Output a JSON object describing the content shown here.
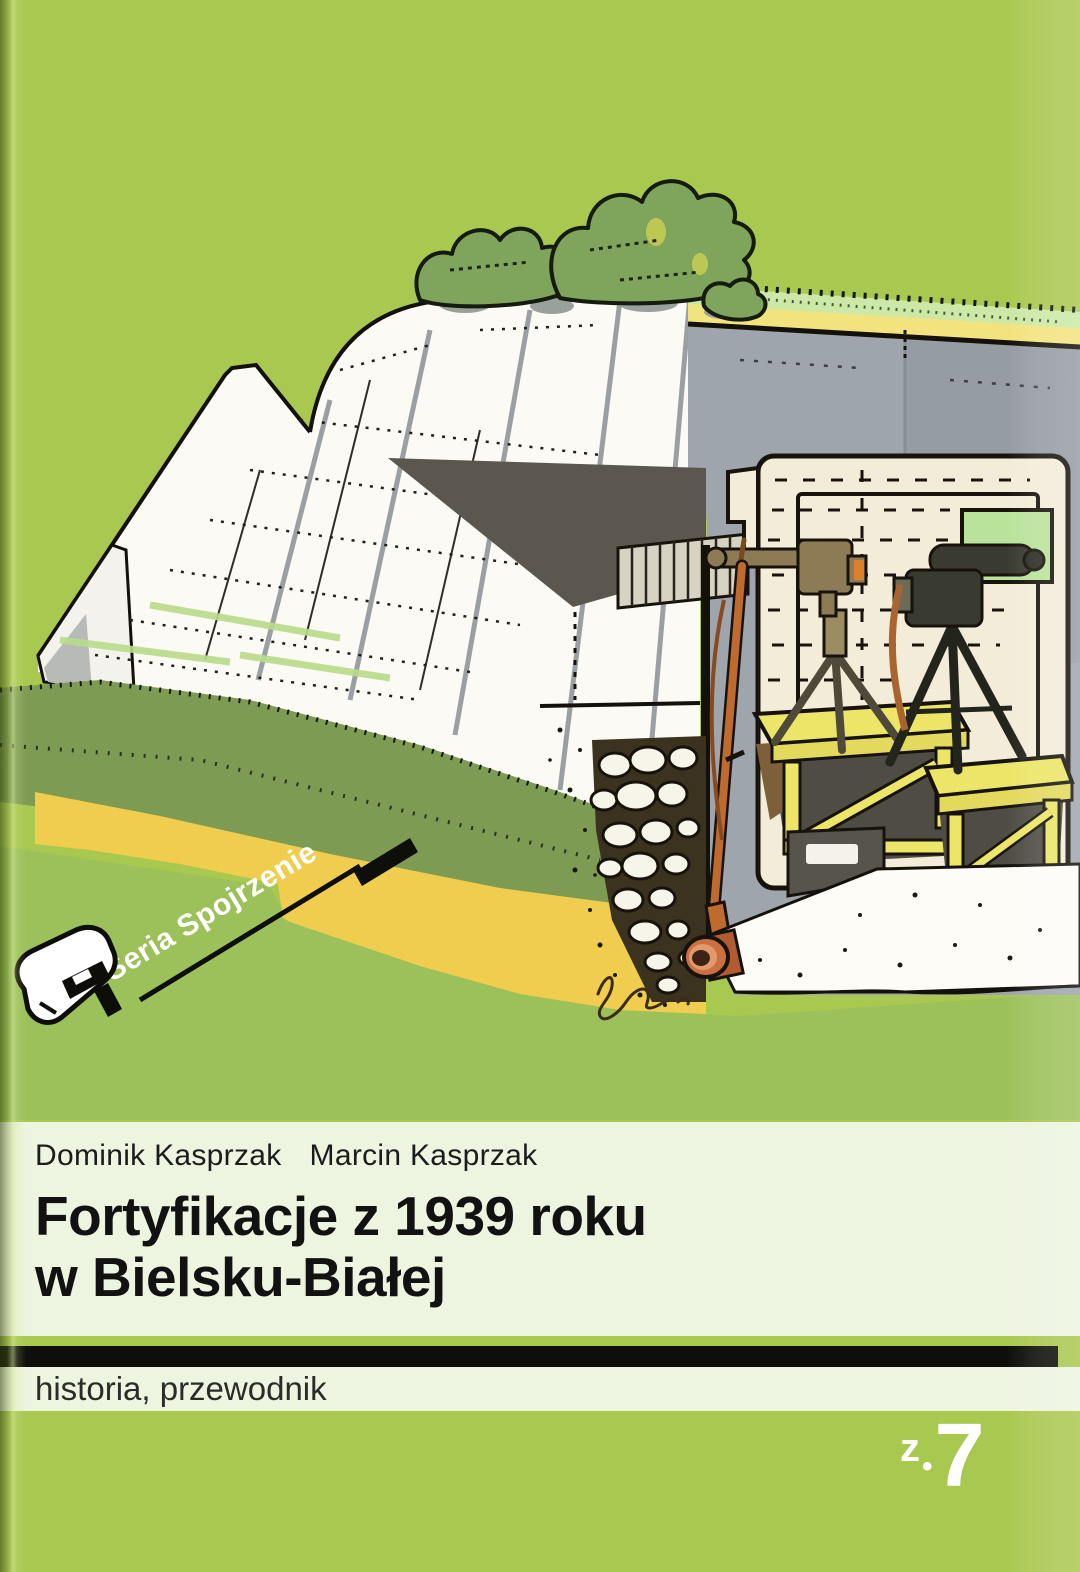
{
  "cover": {
    "series_label": "Seria Spojrzenie",
    "authors": [
      "Dominik Kasprzak",
      "Marcin Kasprzak"
    ],
    "title_line1": "Fortyfikacje z 1939 roku",
    "title_line2": "w Bielsku-Białej",
    "category_label": "historia, przewodnik",
    "volume": {
      "prefix": "z",
      "separator": "•",
      "number": "7"
    },
    "colors": {
      "background_green": "#a9c84f",
      "panel_light": "#edf4e0",
      "band_black": "#0e0e0a",
      "title_text": "#121212",
      "series_text": "#ffffff",
      "volume_text": "#ffffff",
      "concrete_white": "#fbfaf5",
      "concrete_gray": "#9fa5ad",
      "interior_cream": "#f3ecd9",
      "ground_yellow": "#f0cd4e",
      "grass_sage": "#7e9b53",
      "grass_light": "#cbe8a6",
      "table_yellow": "#ece567",
      "bush_green": "#7fa45c",
      "pipe_terracotta": "#cb7040",
      "shadow_dark": "#5b574e"
    }
  }
}
